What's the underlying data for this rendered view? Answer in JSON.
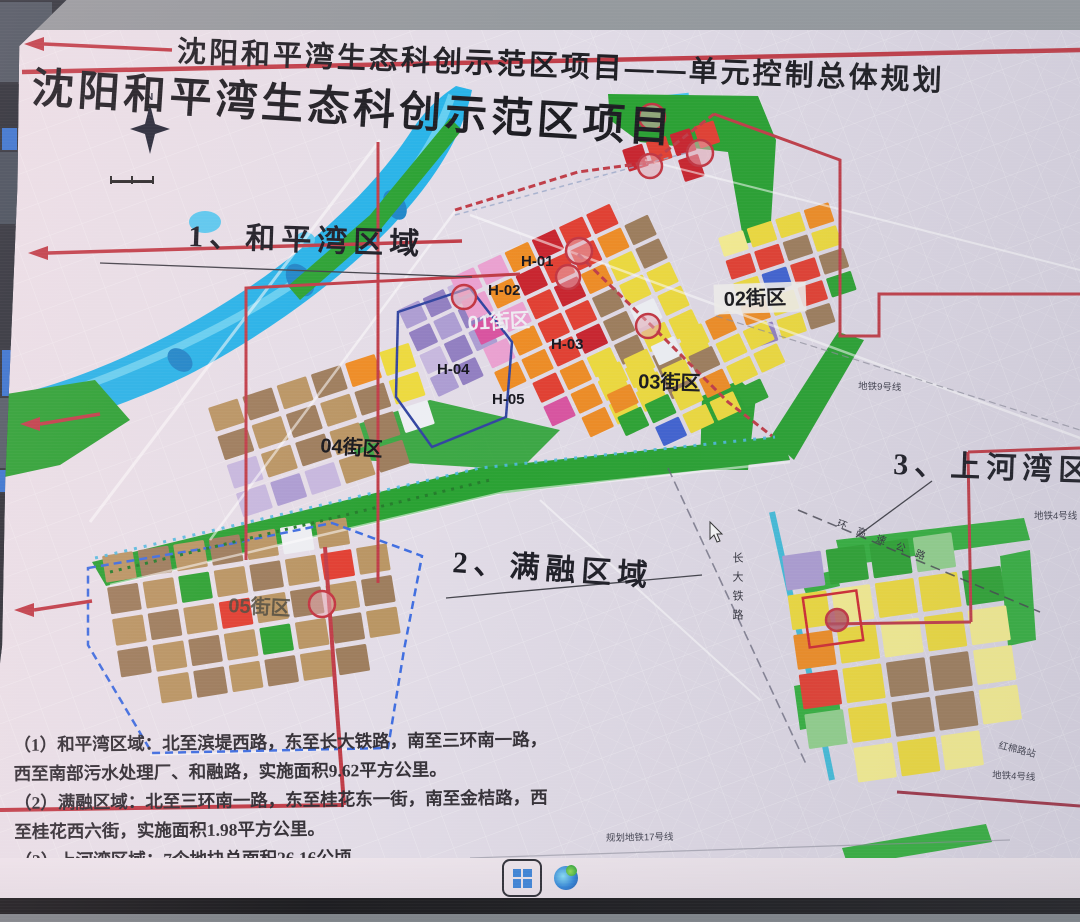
{
  "titles": {
    "main": "沈阳和平湾生态科创示范区项目——单元控制总体规划",
    "slide": "沈阳和平湾生态科创示范区项目"
  },
  "regions": {
    "r1": "1、和平湾区域",
    "r2": "2、满融区域",
    "r3": "3、上河湾区域"
  },
  "units": {
    "h01": "H-01",
    "h02": "H-02",
    "h03": "H-03",
    "h04": "H-04",
    "h05": "H-05"
  },
  "districts": {
    "d01": "01街区",
    "d02": "02街区",
    "d03": "03街区",
    "d04": "04街区",
    "d05": "05街区"
  },
  "annotations": {
    "north": "N",
    "metro9": "地铁9号线",
    "metro4_a": "地铁4号线",
    "metro4_b": "地铁4号线",
    "metro17": "规划地铁17号线",
    "station": "红棉路站",
    "railway": "长大铁路",
    "expressway": "环高速公路"
  },
  "notes": {
    "n1": "（1）和平湾区域：北至滨堤西路，东至长大铁路，南至三环南一路，西至南部污水处理厂、和融路，实施面积9.62平方公里。",
    "n2": "（2）满融区域：北至三环南一路，东至桂花东一街，南至金桔路，西至桂花西六街，实施面积1.98平方公里。",
    "n3": "（3）上河湾区域：7个地块总面积26.16公顷。"
  },
  "taskbar": {
    "icons": [
      "windows-start-icon",
      "edge-icon"
    ]
  },
  "colors": {
    "accent_red": "#bf3742",
    "boundary_blue": "#3a6ae0",
    "water": "#1fb2e9",
    "park_green": "#23a02c",
    "land": "#d9d4e1",
    "palette": {
      "O": "#ef8a1e",
      "R": "#e23a2c",
      "C": "#c81e28",
      "Y": "#eeda38",
      "y": "#f6ee8e",
      "P": "#eb9fd0",
      "M": "#d94f9e",
      "B": "#9b7a58",
      "b": "#b8935f",
      "L": "#c6b7de",
      "U": "#8f7cc0",
      "u": "#ab9bd2",
      "G": "#27a12d",
      "g": "#8fd08a",
      "W": "#eef0f4",
      "A": "#3b5ed0"
    }
  }
}
